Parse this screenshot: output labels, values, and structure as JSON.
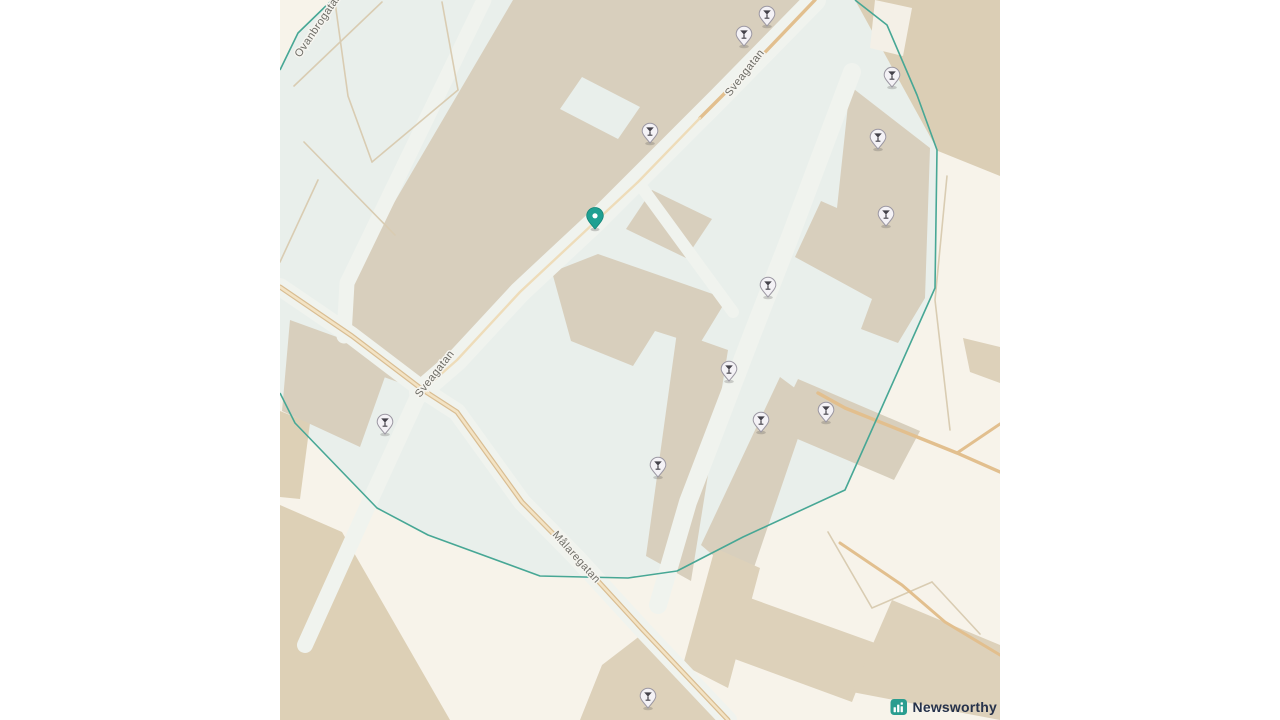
{
  "map": {
    "street_labels": [
      {
        "text": "Sveagatan",
        "x": 450,
        "y": 97,
        "rotation": -52
      },
      {
        "text": "Sveagatan",
        "x": 140,
        "y": 398,
        "rotation": -52
      },
      {
        "text": "Målaregatan",
        "x": 272,
        "y": 535,
        "rotation": 48
      },
      {
        "text": "Ovanbrogatan",
        "x": 20,
        "y": 58,
        "rotation": -56
      }
    ],
    "selected_pin": {
      "x": 315,
      "y": 218,
      "color": "#1fa092"
    },
    "poi_markers": {
      "icon": "cocktail-glass",
      "points": [
        {
          "x": 487,
          "y": 16
        },
        {
          "x": 464,
          "y": 36
        },
        {
          "x": 612,
          "y": 77
        },
        {
          "x": 370,
          "y": 133
        },
        {
          "x": 598,
          "y": 139
        },
        {
          "x": 606,
          "y": 216
        },
        {
          "x": 488,
          "y": 287
        },
        {
          "x": 449,
          "y": 371
        },
        {
          "x": 546,
          "y": 412
        },
        {
          "x": 481,
          "y": 422
        },
        {
          "x": 378,
          "y": 467
        },
        {
          "x": 105,
          "y": 424
        },
        {
          "x": 368,
          "y": 698
        }
      ]
    },
    "zone": {
      "fill_points": "52,0 575,0 607,25 637,95 657,150 655,288 565,490 463,537 397,571 348,578 260,576 148,535 97,508 15,423 0,393 0,70 18,33",
      "outline_paths": [
        "M575,0 L607,25 L637,95 L657,150 L655,288 L565,490 L463,537 L397,571 L348,578 L260,576 L148,535 L97,508 L15,423 L0,393",
        "M0,70 L18,33 L52,0"
      ]
    },
    "colors": {
      "page_background": "#ffffff",
      "map_background": "#f7f3ea",
      "zone_fill": "#e9efeb",
      "zone_outline": "#47a795",
      "building": "#d8cfbd",
      "building_warm": "#dbceb5",
      "street": "#f0f3ee",
      "road_orange": "#e2bf8e",
      "path_tan": "#d9ccb2",
      "pin_teal": "#1fa092",
      "poi_fill": "#f4f2f6",
      "poi_stroke": "#9b97a2"
    }
  },
  "attribution": {
    "brand": "Newsworthy",
    "icon": "newsworthy-bar-chart-logo",
    "icon_color": "#2a9d8f",
    "text_color": "#26324b"
  }
}
